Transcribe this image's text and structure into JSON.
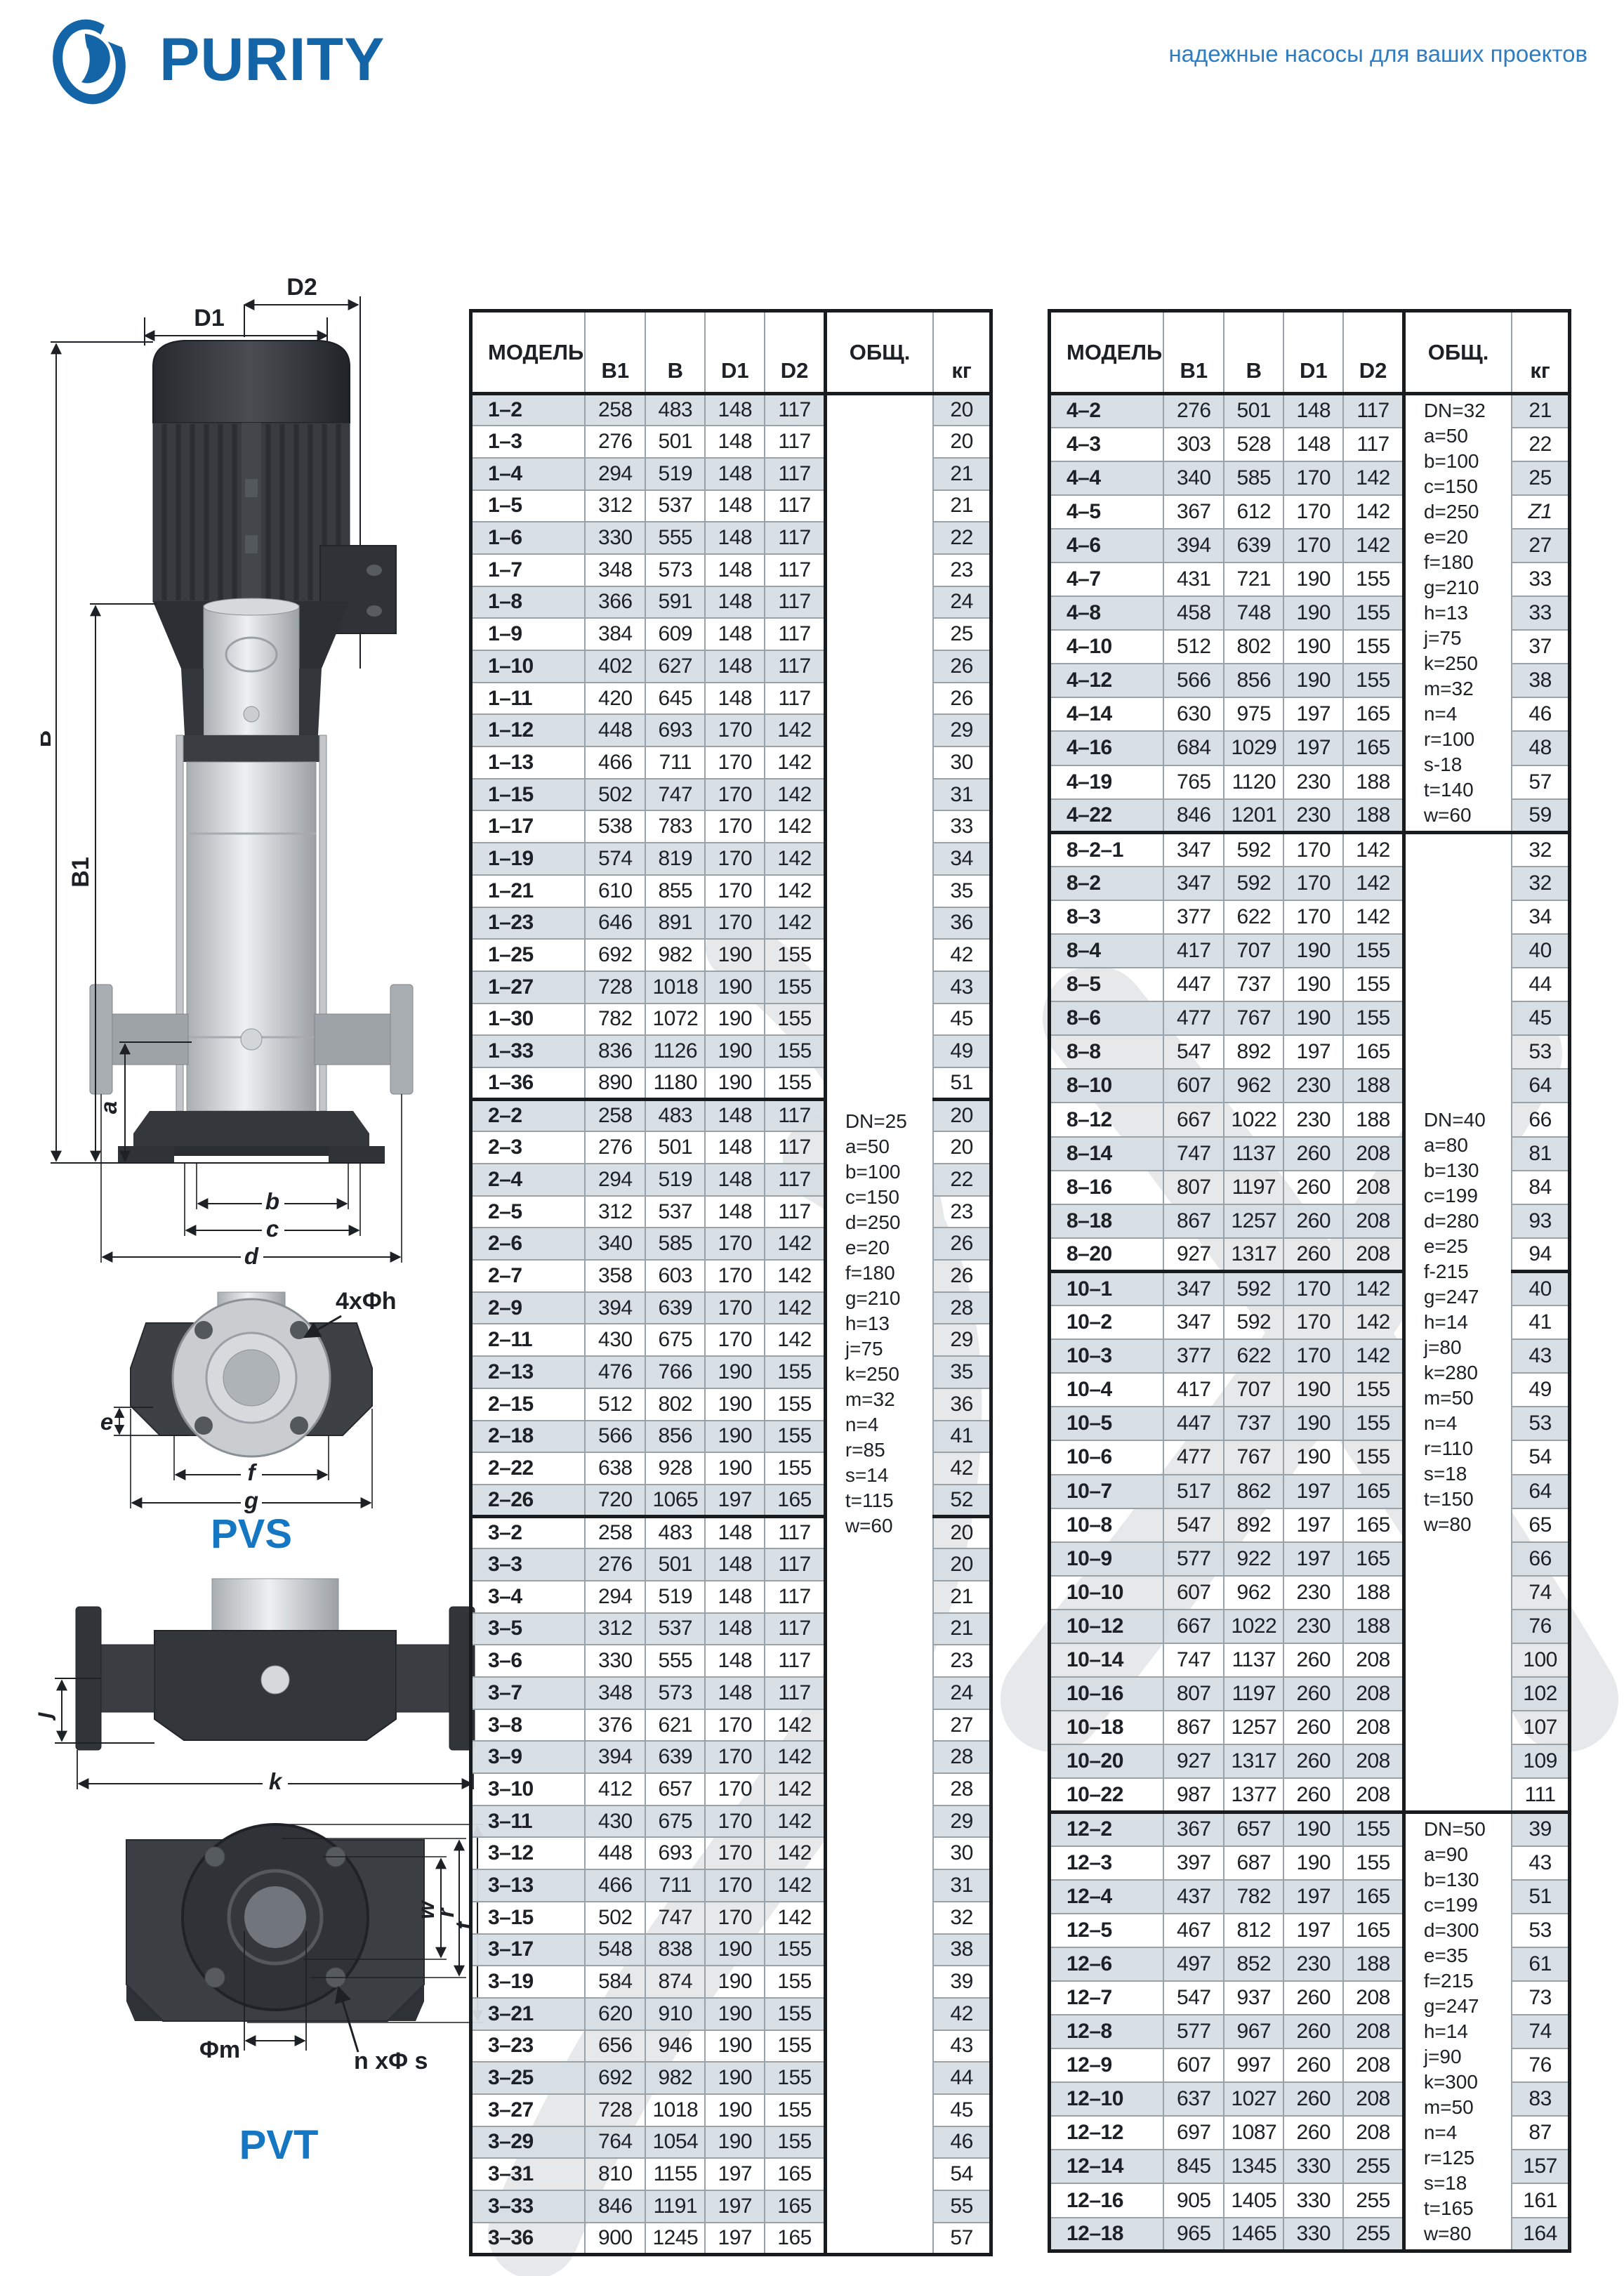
{
  "page": {
    "brand": "PURITY",
    "slogan": "надежные насосы для ваших проектов"
  },
  "diagrams": {
    "pvs": {
      "label": "PVS",
      "d1": "D1",
      "d2": "D2",
      "b": "B",
      "b1": "B1",
      "a": "a",
      "dim_b": "b",
      "dim_c": "c",
      "dim_d": "d",
      "e": "e",
      "f": "f",
      "g": "g",
      "bolts": "4xΦh"
    },
    "pvt": {
      "label": "PVT",
      "j": "j",
      "k": "k",
      "phi_m": "Φm",
      "bolts": "n xΦ s",
      "w": "w",
      "r": "r",
      "t": "t"
    }
  },
  "tables": {
    "left": {
      "headers": {
        "model": "МОДЕЛЬ",
        "b1": "B1",
        "b": "B",
        "d1": "D1",
        "d2": "D2",
        "total": "ОБЩ.",
        "kg": "кг"
      },
      "group_starts": [
        22,
        35
      ],
      "note_spans": [
        {
          "start": 0,
          "count": 58,
          "lines": [
            "DN=25",
            "a=50",
            "b=100",
            "c=150",
            "d=250",
            "e=20",
            "f=180",
            "g=210",
            "h=13",
            "j=75",
            "k=250",
            "m=32",
            "n=4",
            "r=85",
            "s=14",
            "t=115",
            "w=60"
          ]
        }
      ],
      "rows": [
        [
          "1–2",
          258,
          483,
          148,
          117,
          20
        ],
        [
          "1–3",
          276,
          501,
          148,
          117,
          20
        ],
        [
          "1–4",
          294,
          519,
          148,
          117,
          21
        ],
        [
          "1–5",
          312,
          537,
          148,
          117,
          21
        ],
        [
          "1–6",
          330,
          555,
          148,
          117,
          22
        ],
        [
          "1–7",
          348,
          573,
          148,
          117,
          23
        ],
        [
          "1–8",
          366,
          591,
          148,
          117,
          24
        ],
        [
          "1–9",
          384,
          609,
          148,
          117,
          25
        ],
        [
          "1–10",
          402,
          627,
          148,
          117,
          26
        ],
        [
          "1–11",
          420,
          645,
          148,
          117,
          26
        ],
        [
          "1–12",
          448,
          693,
          170,
          142,
          29
        ],
        [
          "1–13",
          466,
          711,
          170,
          142,
          30
        ],
        [
          "1–15",
          502,
          747,
          170,
          142,
          31
        ],
        [
          "1–17",
          538,
          783,
          170,
          142,
          33
        ],
        [
          "1–19",
          574,
          819,
          170,
          142,
          34
        ],
        [
          "1–21",
          610,
          855,
          170,
          142,
          35
        ],
        [
          "1–23",
          646,
          891,
          170,
          142,
          36
        ],
        [
          "1–25",
          692,
          982,
          190,
          155,
          42
        ],
        [
          "1–27",
          728,
          1018,
          190,
          155,
          43
        ],
        [
          "1–30",
          782,
          1072,
          190,
          155,
          45
        ],
        [
          "1–33",
          836,
          1126,
          190,
          155,
          49
        ],
        [
          "1–36",
          890,
          1180,
          190,
          155,
          51
        ],
        [
          "2–2",
          258,
          483,
          148,
          117,
          20
        ],
        [
          "2–3",
          276,
          501,
          148,
          117,
          20
        ],
        [
          "2–4",
          294,
          519,
          148,
          117,
          22
        ],
        [
          "2–5",
          312,
          537,
          148,
          117,
          23
        ],
        [
          "2–6",
          340,
          585,
          170,
          142,
          26
        ],
        [
          "2–7",
          358,
          603,
          170,
          142,
          26
        ],
        [
          "2–9",
          394,
          639,
          170,
          142,
          28
        ],
        [
          "2–11",
          430,
          675,
          170,
          142,
          29
        ],
        [
          "2–13",
          476,
          766,
          190,
          155,
          35
        ],
        [
          "2–15",
          512,
          802,
          190,
          155,
          36
        ],
        [
          "2–18",
          566,
          856,
          190,
          155,
          41
        ],
        [
          "2–22",
          638,
          928,
          190,
          155,
          42
        ],
        [
          "2–26",
          720,
          1065,
          197,
          165,
          52
        ],
        [
          "3–2",
          258,
          483,
          148,
          117,
          20
        ],
        [
          "3–3",
          276,
          501,
          148,
          117,
          20
        ],
        [
          "3–4",
          294,
          519,
          148,
          117,
          21
        ],
        [
          "3–5",
          312,
          537,
          148,
          117,
          21
        ],
        [
          "3–6",
          330,
          555,
          148,
          117,
          23
        ],
        [
          "3–7",
          348,
          573,
          148,
          117,
          24
        ],
        [
          "3–8",
          376,
          621,
          170,
          142,
          27
        ],
        [
          "3–9",
          394,
          639,
          170,
          142,
          28
        ],
        [
          "3–10",
          412,
          657,
          170,
          142,
          28
        ],
        [
          "3–11",
          430,
          675,
          170,
          142,
          29
        ],
        [
          "3–12",
          448,
          693,
          170,
          142,
          30
        ],
        [
          "3–13",
          466,
          711,
          170,
          142,
          31
        ],
        [
          "3–15",
          502,
          747,
          170,
          142,
          32
        ],
        [
          "3–17",
          548,
          838,
          190,
          155,
          38
        ],
        [
          "3–19",
          584,
          874,
          190,
          155,
          39
        ],
        [
          "3–21",
          620,
          910,
          190,
          155,
          42
        ],
        [
          "3–23",
          656,
          946,
          190,
          155,
          43
        ],
        [
          "3–25",
          692,
          982,
          190,
          155,
          44
        ],
        [
          "3–27",
          728,
          1018,
          190,
          155,
          45
        ],
        [
          "3–29",
          764,
          1054,
          190,
          155,
          46
        ],
        [
          "3–31",
          810,
          1155,
          197,
          165,
          54
        ],
        [
          "3–33",
          846,
          1191,
          197,
          165,
          55
        ],
        [
          "3–36",
          900,
          1245,
          197,
          165,
          57
        ]
      ]
    },
    "right": {
      "headers": {
        "model": "МОДЕЛЬ",
        "b1": "B1",
        "b": "B",
        "d1": "D1",
        "d2": "D2",
        "total": "ОБЩ.",
        "kg": "кг"
      },
      "group_starts": [
        13,
        26,
        42
      ],
      "note_spans": [
        {
          "start": 0,
          "count": 13,
          "lines": [
            "DN=32",
            "a=50",
            "b=100",
            "c=150",
            "d=250",
            "e=20",
            "f=180",
            "g=210",
            "h=13",
            "j=75",
            "k=250",
            "m=32",
            "n=4",
            "r=100",
            "s-18",
            "t=140",
            "w=60"
          ]
        },
        {
          "start": 13,
          "count": 29,
          "lines": [
            "DN=40",
            "a=80",
            "b=130",
            "c=199",
            "d=280",
            "e=25",
            "f-215",
            "g=247",
            "h=14",
            "j=80",
            "k=280",
            "m=50",
            "n=4",
            "r=110",
            "s=18",
            "t=150",
            "w=80"
          ]
        },
        {
          "start": 42,
          "count": 13,
          "lines": [
            "DN=50",
            "a=90",
            "b=130",
            "c=199",
            "d=300",
            "e=35",
            "f=215",
            "g=247",
            "h=14",
            "j=90",
            "k=300",
            "m=50",
            "n=4",
            "r=125",
            "s=18",
            "t=165",
            "w=80"
          ]
        }
      ],
      "rows": [
        [
          "4–2",
          276,
          501,
          148,
          117,
          21
        ],
        [
          "4–3",
          303,
          528,
          148,
          117,
          22
        ],
        [
          "4–4",
          340,
          585,
          170,
          142,
          25
        ],
        [
          "4–5",
          367,
          612,
          170,
          142,
          "Z1"
        ],
        [
          "4–6",
          394,
          639,
          170,
          142,
          27
        ],
        [
          "4–7",
          431,
          721,
          190,
          155,
          33
        ],
        [
          "4–8",
          458,
          748,
          190,
          155,
          33
        ],
        [
          "4–10",
          512,
          802,
          190,
          155,
          37
        ],
        [
          "4–12",
          566,
          856,
          190,
          155,
          38
        ],
        [
          "4–14",
          630,
          975,
          197,
          165,
          46
        ],
        [
          "4–16",
          684,
          1029,
          197,
          165,
          48
        ],
        [
          "4–19",
          765,
          1120,
          230,
          188,
          57
        ],
        [
          "4–22",
          846,
          1201,
          230,
          188,
          59
        ],
        [
          "8–2–1",
          347,
          592,
          170,
          142,
          32
        ],
        [
          "8–2",
          347,
          592,
          170,
          142,
          32
        ],
        [
          "8–3",
          377,
          622,
          170,
          142,
          34
        ],
        [
          "8–4",
          417,
          707,
          190,
          155,
          40
        ],
        [
          "8–5",
          447,
          737,
          190,
          155,
          44
        ],
        [
          "8–6",
          477,
          767,
          190,
          155,
          45
        ],
        [
          "8–8",
          547,
          892,
          197,
          165,
          53
        ],
        [
          "8–10",
          607,
          962,
          230,
          188,
          64
        ],
        [
          "8–12",
          667,
          1022,
          230,
          188,
          66
        ],
        [
          "8–14",
          747,
          1137,
          260,
          208,
          81
        ],
        [
          "8–16",
          807,
          1197,
          260,
          208,
          84
        ],
        [
          "8–18",
          867,
          1257,
          260,
          208,
          93
        ],
        [
          "8–20",
          927,
          1317,
          260,
          208,
          94
        ],
        [
          "10–1",
          347,
          592,
          170,
          142,
          40
        ],
        [
          "10–2",
          347,
          592,
          170,
          142,
          41
        ],
        [
          "10–3",
          377,
          622,
          170,
          142,
          43
        ],
        [
          "10–4",
          417,
          707,
          190,
          155,
          49
        ],
        [
          "10–5",
          447,
          737,
          190,
          155,
          53
        ],
        [
          "10–6",
          477,
          767,
          190,
          155,
          54
        ],
        [
          "10–7",
          517,
          862,
          197,
          165,
          64
        ],
        [
          "10–8",
          547,
          892,
          197,
          165,
          65
        ],
        [
          "10–9",
          577,
          922,
          197,
          165,
          66
        ],
        [
          "10–10",
          607,
          962,
          230,
          188,
          74
        ],
        [
          "10–12",
          667,
          1022,
          230,
          188,
          76
        ],
        [
          "10–14",
          747,
          1137,
          260,
          208,
          100
        ],
        [
          "10–16",
          807,
          1197,
          260,
          208,
          102
        ],
        [
          "10–18",
          867,
          1257,
          260,
          208,
          107
        ],
        [
          "10–20",
          927,
          1317,
          260,
          208,
          109
        ],
        [
          "10–22",
          987,
          1377,
          260,
          208,
          111
        ],
        [
          "12–2",
          367,
          657,
          190,
          155,
          39
        ],
        [
          "12–3",
          397,
          687,
          190,
          155,
          43
        ],
        [
          "12–4",
          437,
          782,
          197,
          165,
          51
        ],
        [
          "12–5",
          467,
          812,
          197,
          165,
          53
        ],
        [
          "12–6",
          497,
          852,
          230,
          188,
          61
        ],
        [
          "12–7",
          547,
          937,
          260,
          208,
          73
        ],
        [
          "12–8",
          577,
          967,
          260,
          208,
          74
        ],
        [
          "12–9",
          607,
          997,
          260,
          208,
          76
        ],
        [
          "12–10",
          637,
          1027,
          260,
          208,
          83
        ],
        [
          "12–12",
          697,
          1087,
          260,
          208,
          87
        ],
        [
          "12–14",
          845,
          1345,
          330,
          255,
          157
        ],
        [
          "12–16",
          905,
          1405,
          330,
          255,
          161
        ],
        [
          "12–18",
          965,
          1465,
          330,
          255,
          164
        ]
      ]
    }
  }
}
